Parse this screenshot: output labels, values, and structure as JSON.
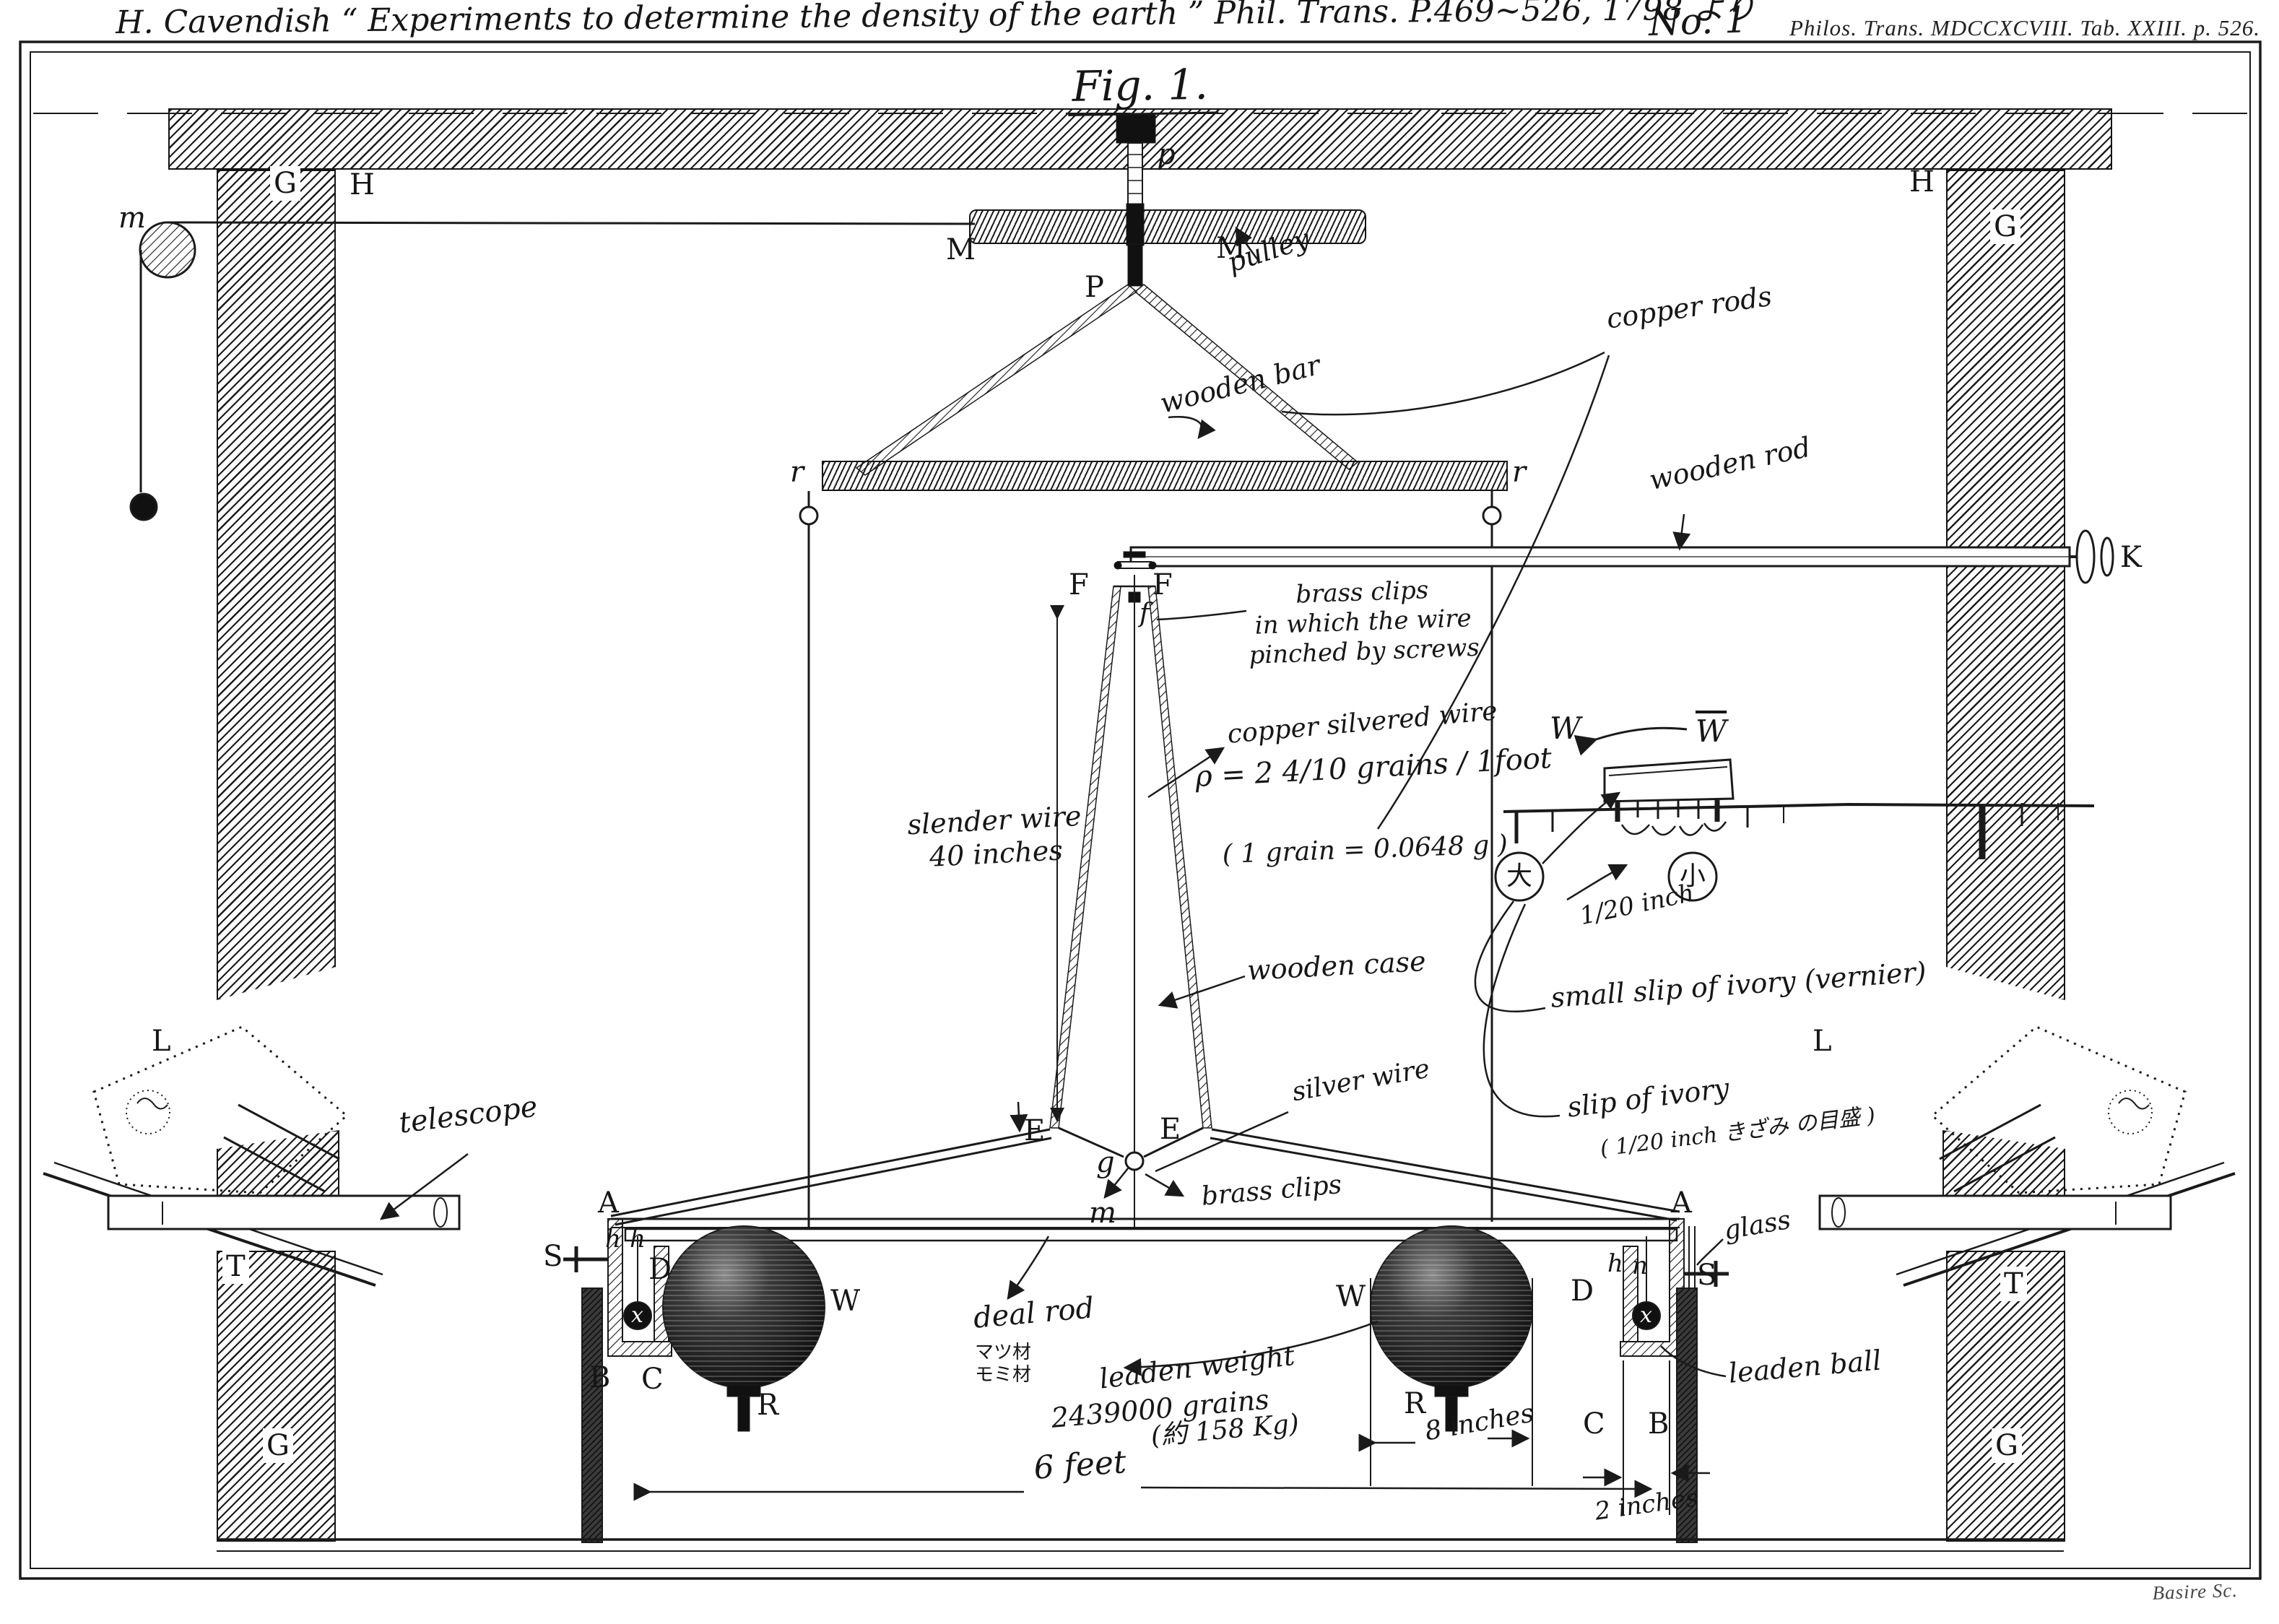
{
  "header": {
    "handwritten_title": "H. Cavendish “ Experiments to determine the density of the earth ”  Phil. Trans. P.469~526, 1798 より",
    "plate_number": "No. 1",
    "printed_reference": "Philos. Trans. MDCCXCVIII. Tab. XXIII. p. 526."
  },
  "figure": {
    "caption": "Fig. 1.",
    "engraver_signature": "Basire Sc."
  },
  "part_labels": {
    "g_top_left": "G",
    "h_top_left": "H",
    "h_top_right": "H",
    "g_top_right": "G",
    "g_bottom_left": "G",
    "g_bottom_right": "G",
    "t_left": "T",
    "t_right": "T",
    "m_pulley_cord": "m",
    "p_top_screw": "p",
    "m_bar_left": "M",
    "m_bar_right": "M",
    "p_pulley": "P",
    "r_left": "r",
    "r_right": "r",
    "k_knob": "K",
    "f_left": "F",
    "f_right": "F",
    "f_wire": "f",
    "l_left": "L",
    "l_right": "L",
    "e_left": "E",
    "e_right": "E",
    "g_stirrup": "g",
    "m_beam": "m",
    "a_left": "A",
    "a_right": "A",
    "s_left": "S",
    "s_right": "S",
    "h_left_1": "h",
    "h_left_2": "h",
    "h_right": "h",
    "n_right": "n",
    "d_left": "D",
    "d_right": "D",
    "x_left": "x",
    "x_right": "x",
    "b_left": "B",
    "c_left": "C",
    "c_right": "C",
    "b_right": "B",
    "w_sphere_left": "W",
    "w_sphere_right": "W",
    "r_screw_left": "R",
    "r_screw_right": "R",
    "w_vernier_left": "W",
    "w_vernier_wall": "W"
  },
  "annotations": {
    "pulley": "pulley",
    "copper_rods": "copper rods",
    "wooden_bar": "wooden bar",
    "wooden_rod": "wooden rod",
    "brass_clips_upper": "brass clips\nin which the wire\npinched by screws",
    "copper_silvered_wire": "copper silvered wire",
    "wire_density": "ρ =  2 4/10  grains / 1foot",
    "grain_conversion": "( 1 grain = 0.0648 g )",
    "slender_wire": "slender wire\n40 inches",
    "wooden_case": "wooden case",
    "vernier_pitch": "1/20 inch",
    "small_slip_of_ivory": "small slip of ivory  (vernier)",
    "slip_of_ivory": "slip of ivory",
    "slip_scale_note": "( 1/20 inch きざみ の目盛 )",
    "silver_wire": "silver wire",
    "brass_clips_lower": "brass clips",
    "telescope": "telescope",
    "deal_rod": "deal rod",
    "deal_rod_material": "マツ材\nモミ材",
    "leaden_weight": "leaden weight",
    "leaden_weight_grains": "2439000 grains",
    "leaden_weight_kg": "(約 158 Kg)",
    "span_six_feet": "6 feet",
    "diameter_eight_inches": "8 inches",
    "gap_two_inches": "2 inches",
    "glass": "glass",
    "leaden_ball": "leaden ball",
    "mark_large": "大",
    "mark_small": "小"
  },
  "colors": {
    "ink": "#1a1a1a",
    "paper": "#ffffff"
  }
}
